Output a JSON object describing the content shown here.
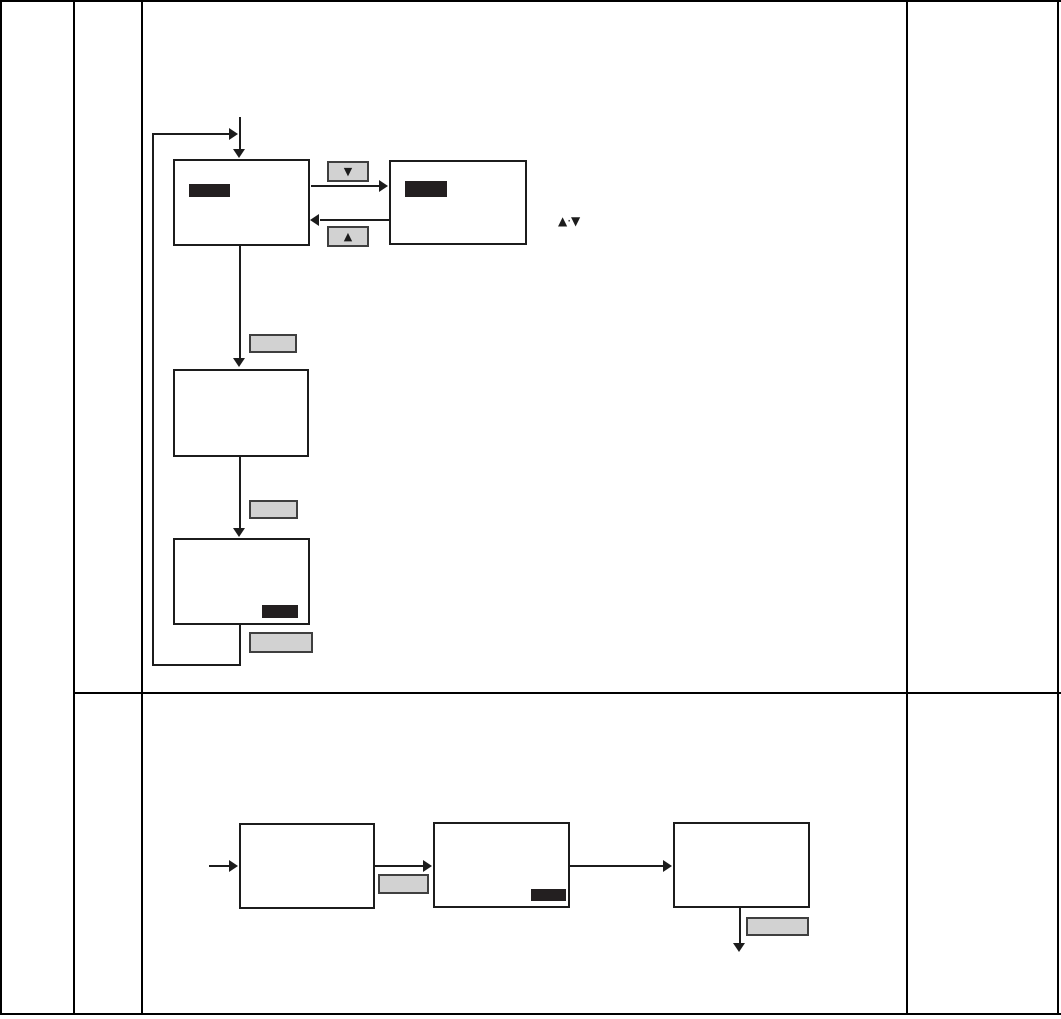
{
  "icons": {
    "down_triangle": "▼",
    "up_triangle": "▲",
    "up_down_keys_label": "▲·▼"
  },
  "colors": {
    "page_background": "#ffffff",
    "table_grid_line": "#000000",
    "flow_line": "#1c1c1c",
    "key_button_fill": "#d2d2d2",
    "key_button_border": "#3f3f3f",
    "display_bar": "#231f20"
  }
}
